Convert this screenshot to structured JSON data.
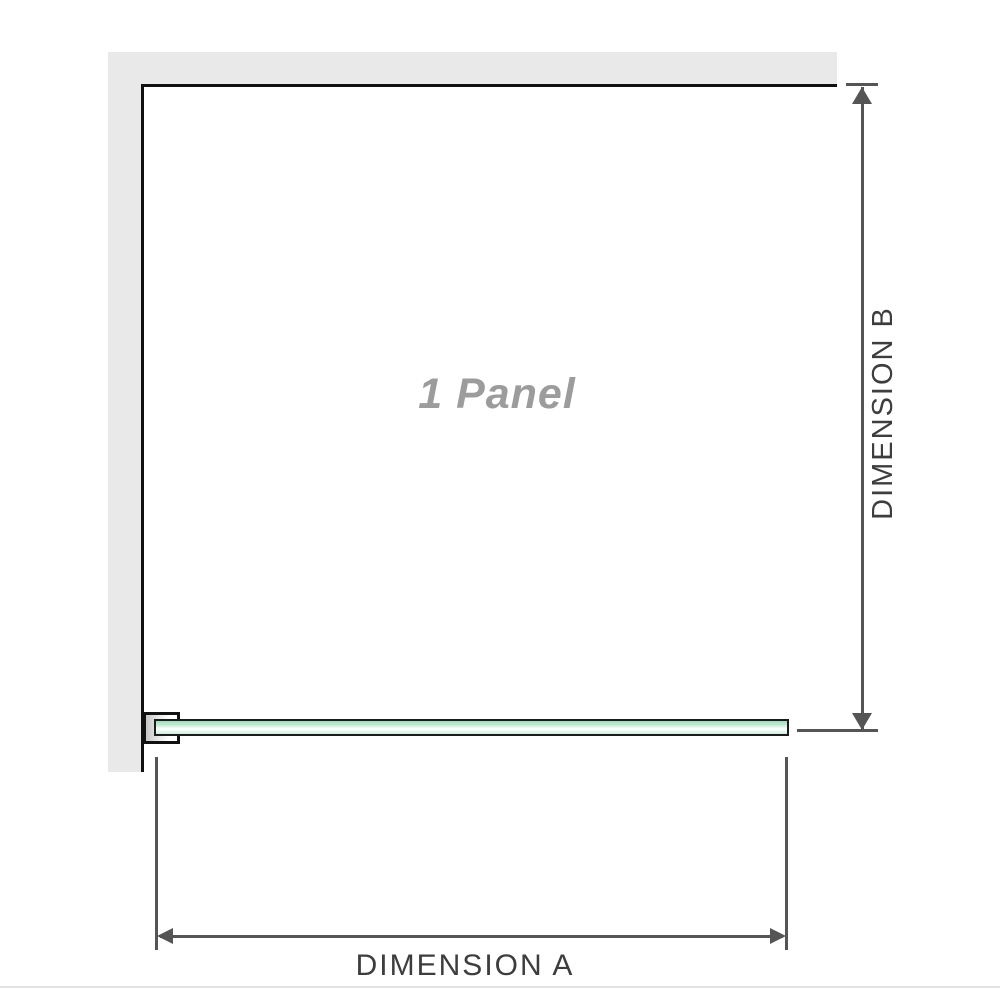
{
  "diagram": {
    "panel_label": "1 Panel",
    "dimension_a_label": "DIMENSION A",
    "dimension_b_label": "DIMENSION B"
  },
  "icons": {
    "dimension_b_top": "arrow-up-icon",
    "dimension_b_bottom": "arrow-down-icon",
    "dimension_a_left": "arrow-left-icon",
    "dimension_a_right": "arrow-right-icon"
  },
  "colors": {
    "wall_fill": "#e9e9e9",
    "outline": "#111111",
    "dimension_line": "#555555",
    "dimension_text": "#3d3d3d",
    "panel_text": "#9c9c9c",
    "glass_border": "#1c1c1c",
    "glass_green": "#9edcbb",
    "glass_green_light": "#eefaf3",
    "baseline": "#e2e2e2"
  }
}
